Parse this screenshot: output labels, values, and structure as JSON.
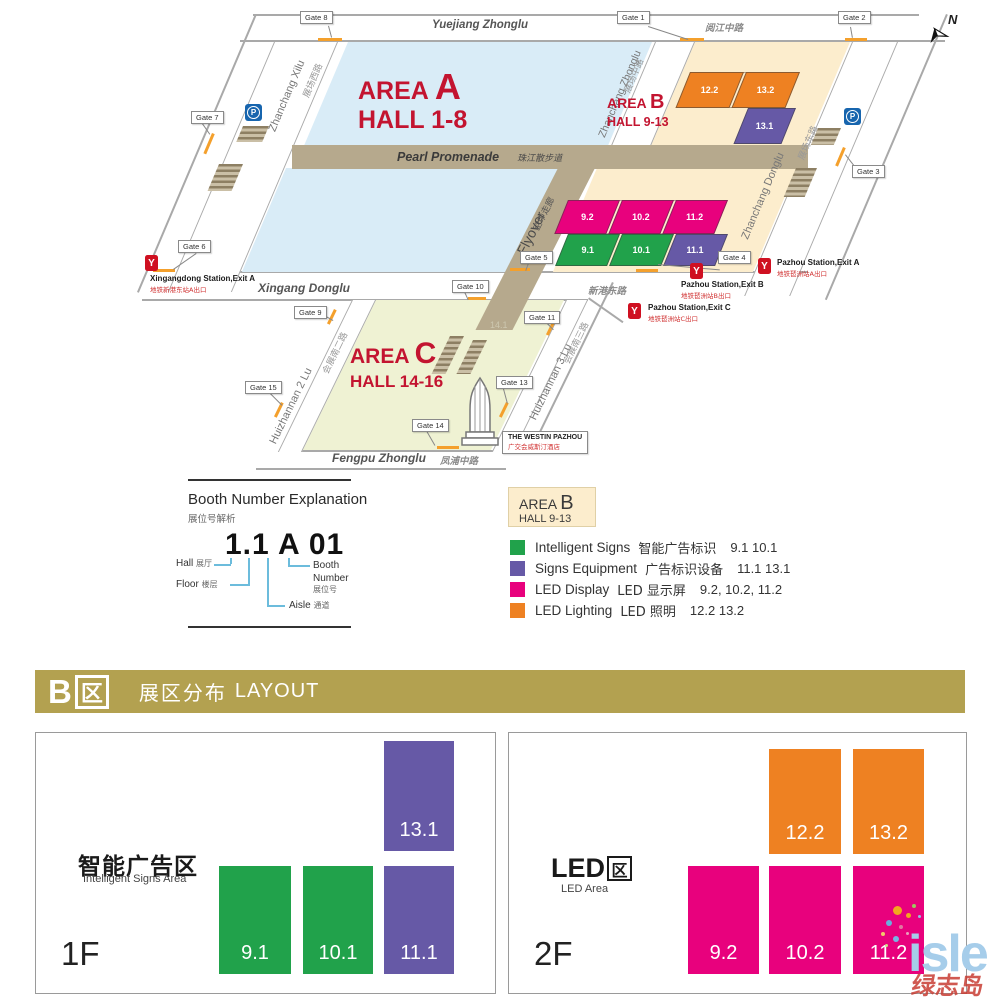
{
  "colors": {
    "green": "#21a24b",
    "purple": "#6659a6",
    "magenta": "#e8017d",
    "orange": "#ee8122",
    "accent_red": "#c31430",
    "banner_gold": "#b3a150",
    "road_tan": "#b6a98d",
    "area_a_fill": "#d9ecf7",
    "area_b_fill": "#fcedcd",
    "area_c_fill": "#eff2d3"
  },
  "map": {
    "north": "N",
    "parking": "P",
    "metro": "Y",
    "areas": {
      "a": {
        "area": "AREA",
        "letter": "A",
        "hall": "HALL 1-8"
      },
      "b": {
        "area": "AREA",
        "letter": "B",
        "hall": "HALL 9-13"
      },
      "c": {
        "area": "AREA",
        "letter": "C",
        "hall": "HALL 14-16"
      }
    },
    "roads": {
      "yuejiang_en": "Yuejiang Zhonglu",
      "yuejiang_zh": "阅江中路",
      "zhanchang_xilu_en": "Zhanchang Xilu",
      "zhanchang_xilu_zh": "展场西路",
      "zhanchang_zhonglu_en": "Zhanchang Zhonglu",
      "zhanchang_zhonglu_zh": "展场中路",
      "zhanchang_donglu_en": "Zhanchang Donglu",
      "zhanchang_donglu_zh": "展场东路",
      "pearl_en": "Pearl Promenade",
      "pearl_zh": "珠江散步道",
      "flyover_en": "Flyover",
      "flyover_zh": "空中走廊",
      "xingang_en": "Xingang Donglu",
      "xingang_zh": "新港东路",
      "huizhannan2_en": "Huizhannan 2 Lu",
      "huizhannan2_zh": "会展南二路",
      "huizhannan3_en": "Huizhannan 3 Lu",
      "huizhannan3_zh": "会展南三路",
      "fengpu_en": "Fengpu Zhonglu",
      "fengpu_zh": "凤浦中路"
    },
    "gates": {
      "g1": "Gate 1",
      "g2": "Gate 2",
      "g3": "Gate 3",
      "g4": "Gate 4",
      "g5": "Gate 5",
      "g6": "Gate 6",
      "g7": "Gate 7",
      "g8": "Gate 8",
      "g9": "Gate 9",
      "g10": "Gate 10",
      "g11": "Gate 11",
      "g13": "Gate 13",
      "g14": "Gate 14",
      "g15": "Gate 15"
    },
    "halls": {
      "h12_2": "12.2",
      "h13_2": "13.2",
      "h13_1": "13.1",
      "h9_2": "9.2",
      "h10_2": "10.2",
      "h11_2": "11.2",
      "h9_1": "9.1",
      "h10_1": "10.1",
      "h11_1": "11.1",
      "faint": "14.1"
    },
    "stations": {
      "xingangdong_a_en": "Xingangdong Station,Exit A",
      "xingangdong_a_zh": "地铁新港东站A出口",
      "pazhou_a_en": "Pazhou Station,Exit A",
      "pazhou_a_zh": "地铁琶洲站A出口",
      "pazhou_b_en": "Pazhou Station,Exit B",
      "pazhou_b_zh": "地铁琶洲站B出口",
      "pazhou_c_en": "Pazhou Station,Exit C",
      "pazhou_c_zh": "地铁琶洲站C出口"
    },
    "westin_en": "THE WESTIN PAZHOU",
    "westin_zh": "广交会威斯汀酒店"
  },
  "booth": {
    "title": "Booth Number Explanation",
    "subtitle": "展位号解析",
    "example": {
      "hall_floor": "1.1",
      "aisle": "A",
      "number": "01"
    },
    "hall_en": "Hall",
    "hall_zh": "展厅",
    "floor_en": "Floor",
    "floor_zh": "楼层",
    "aisle_en": "Aisle",
    "aisle_zh": "通道",
    "booth_en": "Booth",
    "booth_en2": "Number",
    "booth_zh": "展位号"
  },
  "legend": {
    "area": "AREA",
    "letter": "B",
    "hall": "HALL 9-13",
    "items": [
      {
        "en": "Intelligent Signs",
        "zh": "智能广告标识",
        "halls": "9.1 10.1",
        "color": "#21a24b"
      },
      {
        "en": "Signs Equipment",
        "zh": "广告标识设备",
        "halls": "11.1  13.1",
        "color": "#6659a6"
      },
      {
        "en": "LED Display",
        "zh": "LED 显示屏",
        "halls": "9.2, 10.2, 11.2",
        "color": "#e8017d"
      },
      {
        "en": "LED Lighting",
        "zh": "LED 照明",
        "halls": "12.2  13.2",
        "color": "#ee8122"
      }
    ]
  },
  "banner": {
    "letter": "B",
    "boxchar": "区",
    "zh": "展区分布",
    "en": "LAYOUT"
  },
  "floors": [
    {
      "id": "1F",
      "zone": "智能广告区",
      "zone_en": "Intelligent Signs Area",
      "blocks": [
        {
          "label": "13.1",
          "color": "#6659a6"
        },
        {
          "label": "9.1",
          "color": "#21a24b"
        },
        {
          "label": "10.1",
          "color": "#21a24b"
        },
        {
          "label": "11.1",
          "color": "#6659a6"
        }
      ]
    },
    {
      "id": "2F",
      "zone": "LED",
      "zone_boxchar": "区",
      "zone_en": "LED Area",
      "blocks": [
        {
          "label": "12.2",
          "color": "#ee8122"
        },
        {
          "label": "13.2",
          "color": "#ee8122"
        },
        {
          "label": "9.2",
          "color": "#e8017d"
        },
        {
          "label": "10.2",
          "color": "#e8017d"
        },
        {
          "label": "11.2",
          "color": "#e8017d"
        }
      ]
    }
  ],
  "watermark": {
    "en": "isle",
    "zh": "绿志岛"
  }
}
